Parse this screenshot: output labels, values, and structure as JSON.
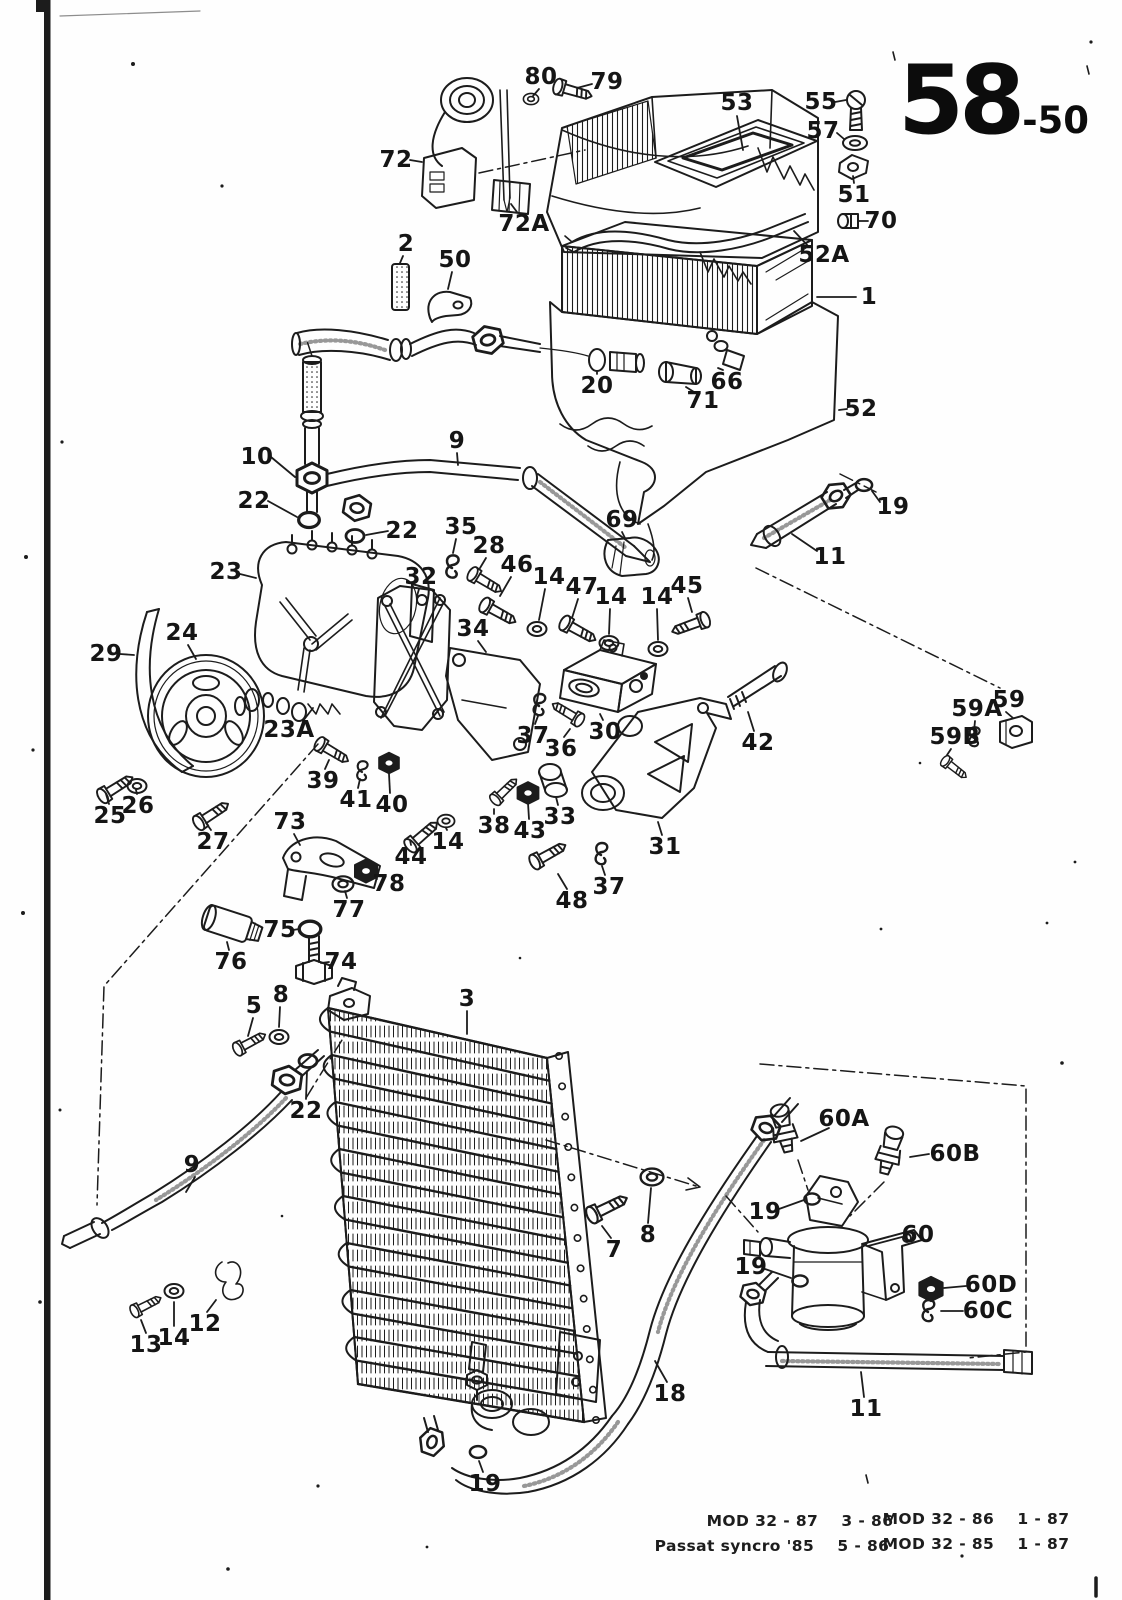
{
  "page": {
    "number_big": "58",
    "number_small": "-50",
    "footer": [
      {
        "text": "MOD 32 - 87    3 - 86",
        "x": 800,
        "y": 1521
      },
      {
        "text": "MOD 32 - 86    1 - 87",
        "x": 976,
        "y": 1519
      },
      {
        "text": "Passat syncro '85    5 - 86",
        "x": 772,
        "y": 1546
      },
      {
        "text": "MOD 32 - 85    1 - 87",
        "x": 976,
        "y": 1544
      }
    ]
  },
  "diagram": {
    "description": "Exploded parts diagram of air conditioning system (evaporator housing, compressor with brackets, condenser, receiver drier, hoses)",
    "labels": [
      {
        "t": "80",
        "x": 541,
        "y": 77,
        "l": [
          539,
          89,
          533,
          96
        ]
      },
      {
        "t": "79",
        "x": 607,
        "y": 82,
        "l": [
          592,
          84,
          577,
          88
        ]
      },
      {
        "t": "53",
        "x": 737,
        "y": 103,
        "l": [
          737,
          116,
          743,
          150
        ]
      },
      {
        "t": "55",
        "x": 821,
        "y": 102,
        "l": [
          835,
          102,
          846,
          100
        ]
      },
      {
        "t": "57",
        "x": 823,
        "y": 131,
        "l": [
          837,
          133,
          844,
          139
        ]
      },
      {
        "t": "51",
        "x": 854,
        "y": 195,
        "l": [
          854,
          183,
          853,
          176
        ]
      },
      {
        "t": "70",
        "x": 881,
        "y": 221,
        "l": [
          868,
          221,
          859,
          221
        ]
      },
      {
        "t": "52A",
        "x": 824,
        "y": 255,
        "l": [
          809,
          247,
          794,
          231
        ]
      },
      {
        "t": "72",
        "x": 396,
        "y": 160,
        "l": [
          410,
          160,
          422,
          162
        ]
      },
      {
        "t": "72A",
        "x": 524,
        "y": 224,
        "l": [
          517,
          212,
          511,
          204
        ]
      },
      {
        "t": "2",
        "x": 406,
        "y": 244,
        "l": [
          403,
          256,
          400,
          263
        ]
      },
      {
        "t": "50",
        "x": 455,
        "y": 260,
        "l": [
          452,
          272,
          448,
          289
        ]
      },
      {
        "t": "1",
        "x": 869,
        "y": 297,
        "l": [
          856,
          297,
          817,
          297
        ]
      },
      {
        "t": "20",
        "x": 597,
        "y": 386,
        "l": [
          597,
          374,
          597,
          372
        ]
      },
      {
        "t": "66",
        "x": 727,
        "y": 382,
        "l": [
          723,
          370,
          718,
          368
        ]
      },
      {
        "t": "71",
        "x": 703,
        "y": 401,
        "l": [
          694,
          392,
          686,
          387
        ]
      },
      {
        "t": "52",
        "x": 861,
        "y": 409,
        "l": [
          847,
          409,
          839,
          410
        ]
      },
      {
        "t": "69",
        "x": 622,
        "y": 520,
        "l": [
          622,
          532,
          625,
          538
        ]
      },
      {
        "t": "19",
        "x": 893,
        "y": 507,
        "l": [
          880,
          502,
          872,
          491
        ]
      },
      {
        "t": "11",
        "x": 830,
        "y": 557,
        "l": [
          817,
          551,
          792,
          534
        ]
      },
      {
        "t": "10",
        "x": 257,
        "y": 457,
        "l": [
          271,
          457,
          295,
          477
        ]
      },
      {
        "t": "22",
        "x": 254,
        "y": 501,
        "l": [
          268,
          501,
          297,
          517
        ]
      },
      {
        "t": "22",
        "x": 402,
        "y": 531,
        "l": [
          388,
          531,
          366,
          535
        ]
      },
      {
        "t": "9",
        "x": 457,
        "y": 441,
        "l": [
          457,
          453,
          458,
          465
        ]
      },
      {
        "t": "23",
        "x": 226,
        "y": 572,
        "l": [
          240,
          574,
          256,
          578
        ]
      },
      {
        "t": "35",
        "x": 461,
        "y": 527,
        "l": [
          456,
          539,
          453,
          553
        ]
      },
      {
        "t": "28",
        "x": 489,
        "y": 546,
        "l": [
          486,
          558,
          480,
          568
        ]
      },
      {
        "t": "32",
        "x": 421,
        "y": 577,
        "l": [
          419,
          589,
          417,
          596
        ]
      },
      {
        "t": "46",
        "x": 517,
        "y": 565,
        "l": [
          511,
          577,
          500,
          596
        ]
      },
      {
        "t": "14",
        "x": 549,
        "y": 577,
        "l": [
          545,
          589,
          539,
          620
        ]
      },
      {
        "t": "47",
        "x": 582,
        "y": 587,
        "l": [
          578,
          599,
          572,
          618
        ]
      },
      {
        "t": "14",
        "x": 611,
        "y": 597,
        "l": [
          610,
          609,
          609,
          634
        ]
      },
      {
        "t": "14",
        "x": 657,
        "y": 597,
        "l": [
          657,
          609,
          658,
          640
        ]
      },
      {
        "t": "45",
        "x": 687,
        "y": 586,
        "l": [
          688,
          598,
          692,
          612
        ]
      },
      {
        "t": "29",
        "x": 106,
        "y": 654,
        "l": [
          120,
          654,
          134,
          655
        ]
      },
      {
        "t": "24",
        "x": 182,
        "y": 633,
        "l": [
          188,
          645,
          196,
          659
        ]
      },
      {
        "t": "23A",
        "x": 289,
        "y": 730,
        "l": [
          303,
          721,
          313,
          708
        ]
      },
      {
        "t": "34",
        "x": 473,
        "y": 629,
        "l": [
          478,
          641,
          486,
          652
        ]
      },
      {
        "t": "30",
        "x": 605,
        "y": 732,
        "l": [
          603,
          720,
          600,
          714
        ]
      },
      {
        "t": "37",
        "x": 533,
        "y": 736,
        "l": [
          535,
          724,
          538,
          716
        ]
      },
      {
        "t": "36",
        "x": 561,
        "y": 749,
        "l": [
          564,
          737,
          570,
          729
        ]
      },
      {
        "t": "42",
        "x": 758,
        "y": 743,
        "l": [
          754,
          731,
          748,
          712
        ]
      },
      {
        "t": "59",
        "x": 1009,
        "y": 700,
        "l": [
          1006,
          712,
          1013,
          718
        ]
      },
      {
        "t": "59A",
        "x": 977,
        "y": 709,
        "l": [
          975,
          721,
          974,
          731
        ]
      },
      {
        "t": "59B",
        "x": 955,
        "y": 737,
        "l": [
          951,
          749,
          947,
          755
        ]
      },
      {
        "t": "25",
        "x": 110,
        "y": 816,
        "l": [
          109,
          804,
          106,
          794
        ]
      },
      {
        "t": "26",
        "x": 138,
        "y": 806,
        "l": [
          137,
          794,
          136,
          790
        ]
      },
      {
        "t": "27",
        "x": 213,
        "y": 842,
        "l": [
          211,
          830,
          206,
          823
        ]
      },
      {
        "t": "39",
        "x": 323,
        "y": 781,
        "l": [
          325,
          769,
          329,
          760
        ]
      },
      {
        "t": "41",
        "x": 356,
        "y": 800,
        "l": [
          358,
          788,
          360,
          779
        ]
      },
      {
        "t": "40",
        "x": 392,
        "y": 805,
        "l": [
          390,
          793,
          389,
          774
        ]
      },
      {
        "t": "38",
        "x": 494,
        "y": 826,
        "l": [
          494,
          814,
          494,
          809
        ]
      },
      {
        "t": "43",
        "x": 530,
        "y": 831,
        "l": [
          529,
          819,
          528,
          803
        ]
      },
      {
        "t": "33",
        "x": 560,
        "y": 817,
        "l": [
          558,
          805,
          556,
          797
        ]
      },
      {
        "t": "31",
        "x": 665,
        "y": 847,
        "l": [
          662,
          835,
          658,
          822
        ]
      },
      {
        "t": "73",
        "x": 290,
        "y": 822,
        "l": [
          294,
          834,
          300,
          845
        ]
      },
      {
        "t": "44",
        "x": 411,
        "y": 857,
        "l": [
          411,
          845,
          410,
          840
        ]
      },
      {
        "t": "14",
        "x": 448,
        "y": 842,
        "l": [
          447,
          830,
          446,
          828
        ]
      },
      {
        "t": "78",
        "x": 389,
        "y": 884,
        "l": [
          377,
          879,
          375,
          874
        ]
      },
      {
        "t": "77",
        "x": 349,
        "y": 910,
        "l": [
          347,
          898,
          345,
          891
        ]
      },
      {
        "t": "75",
        "x": 280,
        "y": 930,
        "l": [
          293,
          930,
          299,
          929
        ]
      },
      {
        "t": "76",
        "x": 231,
        "y": 962,
        "l": [
          229,
          950,
          227,
          942
        ]
      },
      {
        "t": "74",
        "x": 341,
        "y": 962,
        "l": [
          329,
          962,
          321,
          963
        ]
      },
      {
        "t": "48",
        "x": 572,
        "y": 901,
        "l": [
          567,
          889,
          558,
          874
        ]
      },
      {
        "t": "37",
        "x": 609,
        "y": 887,
        "l": [
          605,
          875,
          602,
          866
        ]
      },
      {
        "t": "5",
        "x": 254,
        "y": 1006,
        "l": [
          253,
          1018,
          248,
          1036
        ]
      },
      {
        "t": "8",
        "x": 281,
        "y": 995,
        "l": [
          280,
          1007,
          279,
          1027
        ]
      },
      {
        "t": "3",
        "x": 467,
        "y": 999,
        "l": [
          467,
          1011,
          467,
          1034
        ]
      },
      {
        "t": "22",
        "x": 306,
        "y": 1111,
        "l": [
          306,
          1099,
          307,
          1071
        ]
      },
      {
        "t": "9",
        "x": 192,
        "y": 1165,
        "l": [
          195,
          1177,
          186,
          1192
        ]
      },
      {
        "t": "13",
        "x": 146,
        "y": 1345,
        "l": [
          146,
          1333,
          141,
          1320
        ]
      },
      {
        "t": "14",
        "x": 174,
        "y": 1338,
        "l": [
          174,
          1326,
          174,
          1302
        ]
      },
      {
        "t": "12",
        "x": 205,
        "y": 1324,
        "l": [
          207,
          1312,
          216,
          1300
        ]
      },
      {
        "t": "7",
        "x": 614,
        "y": 1250,
        "l": [
          611,
          1238,
          602,
          1226
        ]
      },
      {
        "t": "8",
        "x": 648,
        "y": 1235,
        "l": [
          648,
          1223,
          651,
          1188
        ]
      },
      {
        "t": "18",
        "x": 670,
        "y": 1394,
        "l": [
          667,
          1382,
          655,
          1361
        ]
      },
      {
        "t": "19",
        "x": 485,
        "y": 1484,
        "l": [
          483,
          1472,
          479,
          1461
        ]
      },
      {
        "t": "60A",
        "x": 844,
        "y": 1119,
        "l": [
          829,
          1128,
          801,
          1141
        ]
      },
      {
        "t": "60B",
        "x": 955,
        "y": 1154,
        "l": [
          929,
          1154,
          910,
          1157
        ]
      },
      {
        "t": "19",
        "x": 765,
        "y": 1212,
        "l": [
          779,
          1209,
          804,
          1200
        ]
      },
      {
        "t": "60",
        "x": 918,
        "y": 1235,
        "l": [
          902,
          1237,
          868,
          1246
        ]
      },
      {
        "t": "19",
        "x": 751,
        "y": 1267,
        "l": [
          765,
          1269,
          791,
          1278
        ]
      },
      {
        "t": "60D",
        "x": 991,
        "y": 1285,
        "l": [
          966,
          1286,
          944,
          1288
        ]
      },
      {
        "t": "60C",
        "x": 988,
        "y": 1311,
        "l": [
          963,
          1311,
          941,
          1311
        ]
      },
      {
        "t": "11",
        "x": 866,
        "y": 1409,
        "l": [
          864,
          1397,
          861,
          1372
        ]
      }
    ]
  }
}
